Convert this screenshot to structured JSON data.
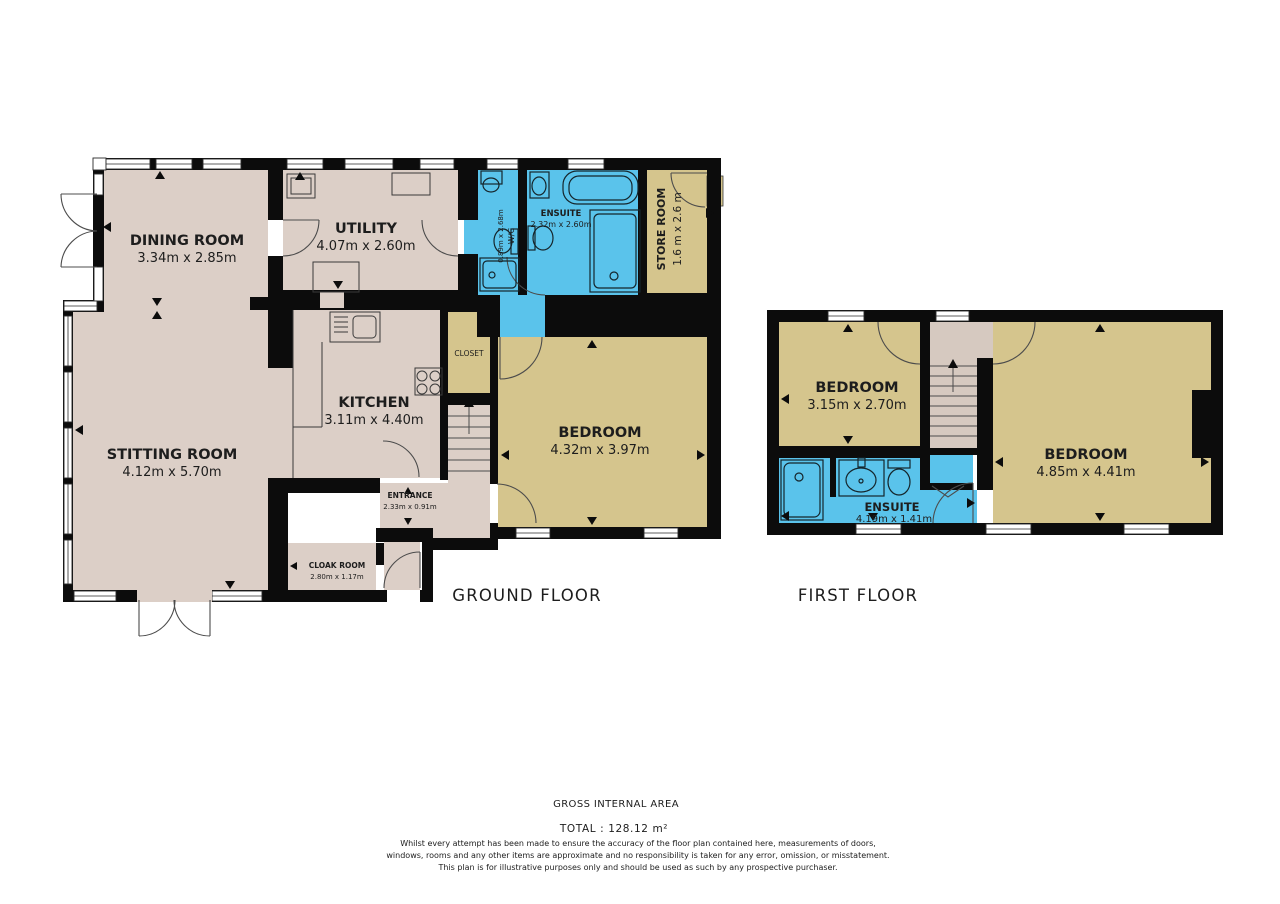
{
  "ground_floor": {
    "label": "GROUND FLOOR",
    "rooms": {
      "dining": {
        "name": "DINING ROOM",
        "dims": "3.34m x 2.85m"
      },
      "utility": {
        "name": "UTILITY",
        "dims": "4.07m x 2.60m"
      },
      "wc": {
        "name": "W/C",
        "dims": "0.89m x 2.68m"
      },
      "ensuite": {
        "name": "ENSUITE",
        "dims": "2.32m x 2.60m"
      },
      "store": {
        "name": "STORE ROOM",
        "dims": "1.6 m x 2.6 m"
      },
      "closet": {
        "name": "CLOSET"
      },
      "kitchen": {
        "name": "KITCHEN",
        "dims": "3.11m x 4.40m"
      },
      "sitting": {
        "name": "STITTING ROOM",
        "dims": "4.12m x 5.70m"
      },
      "bedroom": {
        "name": "BEDROOM",
        "dims": "4.32m x 3.97m"
      },
      "entrance": {
        "name": "ENTRANCE",
        "dims": "2.33m x 0.91m"
      },
      "cloak": {
        "name": "CLOAK ROOM",
        "dims": "2.80m x 1.17m"
      }
    }
  },
  "first_floor": {
    "label": "FIRST FLOOR",
    "rooms": {
      "bedroom_left": {
        "name": "BEDROOM",
        "dims": "3.15m x 2.70m"
      },
      "bedroom_right": {
        "name": "BEDROOM",
        "dims": "4.85m x 4.41m"
      },
      "ensuite": {
        "name": "ENSUITE",
        "dims": "4.19m x 1.41m"
      }
    }
  },
  "footer": {
    "area_title": "GROSS INTERNAL AREA",
    "total": "TOTAL : 128.12 m²",
    "disclaimer": [
      "Whilst every attempt has been made to ensure the accuracy of the floor plan contained here, measurements of doors,",
      "windows, rooms and any other items are approximate and no responsibility is taken for any error, omission, or misstatement.",
      "This plan is for illustrative purposes only and should be used as such by any prospective purchaser."
    ]
  },
  "colors": {
    "room_taupe": "#dccfc7",
    "room_khaki": "#d5c58d",
    "room_wet_blue": "#5ac3eb",
    "wall": "#0c0c0c"
  }
}
